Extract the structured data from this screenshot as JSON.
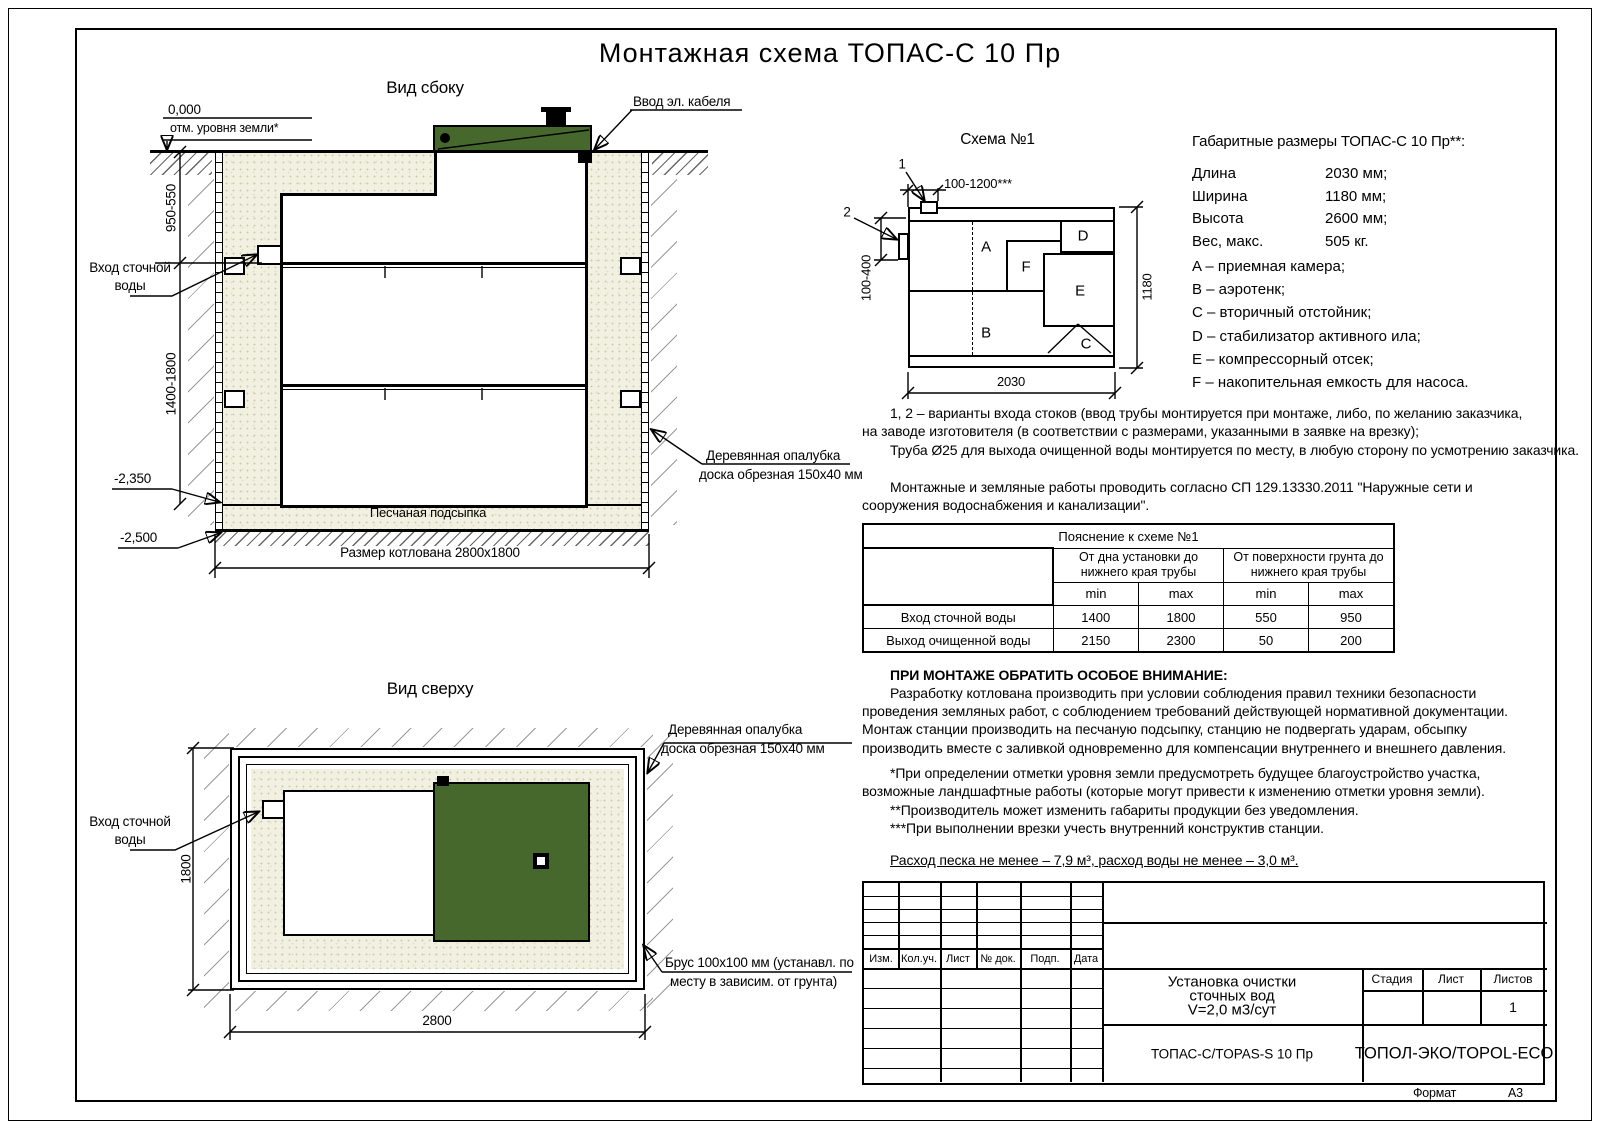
{
  "page": {
    "title": "Монтажная схема ТОПАС-С 10 Пр",
    "format_label": "Формат",
    "format_value": "А3"
  },
  "colors": {
    "lid_green": "#46682c",
    "sand": "#f2f1e1"
  },
  "labels": {
    "inlet1": "Вход сточной",
    "inlet2": "воды",
    "formwork1": "Деревянная опалубка",
    "formwork2": "доска обрезная 150х40 мм"
  },
  "side_view": {
    "title": "Вид сбоку",
    "level_zero": "0,000",
    "level_zero_note": "отм. уровня земли*",
    "cable": "Ввод эл. кабеля",
    "dim_upper": "950-550",
    "dim_lower": "1400-1800",
    "level_mid": "-2,350",
    "level_bottom": "-2,500",
    "sand": "Песчаная подсыпка",
    "pit_dim": "Размер котлована 2800х1800"
  },
  "schema": {
    "title": "Схема №1",
    "m1": "1",
    "m2": "2",
    "dim_top": "100-1200***",
    "dim_left": "100-400",
    "dim_w": "2030",
    "dim_h": "1180",
    "comp": {
      "a": "A",
      "b": "B",
      "c": "C",
      "d": "D",
      "e": "E",
      "f": "F"
    }
  },
  "dims": {
    "title": "Габаритные размеры ТОПАС-С 10 Пр**:",
    "rows": [
      {
        "l": "Длина",
        "v": "2030 мм;"
      },
      {
        "l": "Ширина",
        "v": "1180 мм;"
      },
      {
        "l": "Высота",
        "v": "2600 мм;"
      },
      {
        "l": "Вес, макс.",
        "v": "505 кг."
      }
    ]
  },
  "legend": [
    "A – приемная камера;",
    "B – аэротенк;",
    "C – вторичный отстойник;",
    "D – стабилизатор активного ила;",
    "E – компрессорный отсек;",
    "F – накопительная емкость для насоса."
  ],
  "notes": {
    "p1": "1, 2 – варианты входа  стоков (ввод трубы монтируется при монтаже, либо, по желанию заказчика, на заводе изготовителя (в соответствии с размерами, указанными в заявке на врезку);",
    "p2": "Труба Ø25 для выхода очищенной воды монтируется по месту, в любую сторону по усмотрению заказчика.",
    "p3": "Монтажные и земляные работы проводить согласно СП 129.13330.2011 \"Наружные сети и сооружения водоснабжения и канализации\"."
  },
  "table": {
    "title": "Пояснение к схеме №1",
    "g1": "От дна установки до нижнего края трубы",
    "g2": "От поверхности грунта до нижнего края трубы",
    "min": "min",
    "max": "max",
    "rows": [
      {
        "l": "Вход сточной воды",
        "v": [
          "1400",
          "1800",
          "550",
          "950"
        ]
      },
      {
        "l": "Выход очищенной воды",
        "v": [
          "2150",
          "2300",
          "50",
          "200"
        ]
      }
    ]
  },
  "attention": {
    "title": "ПРИ МОНТАЖЕ ОБРАТИТЬ ОСОБОЕ ВНИМАНИЕ:",
    "body": "Разработку котлована производить при условии соблюдения правил техники безопасности проведения земляных работ, с соблюдением требований действующей нормативной документации. Монтаж станции производить на песчаную подсыпку, станцию не подвергать ударам, обсыпку производить вместе с заливкой одновременно для компенсации внутреннего и внешнего давления."
  },
  "footnotes": [
    "*При определении отметки уровня земли предусмотреть будущее благоустройство участка, возможные ландшафтные работы (которые могут привести к изменению отметки уровня земли).",
    "**Производитель может изменить габариты продукции без уведомления.",
    "***При выполнении врезки учесть внутренний конструктив станции."
  ],
  "consumption": "Расход песка не менее – 7,9 м³, расход воды не менее – 3,0 м³.",
  "top_view": {
    "title": "Вид сверху",
    "dim_w": "2800",
    "dim_h": "1800",
    "brus1": "Брус 100х100 мм (устанавл. по",
    "brus2": "месту в зависим. от грунта)"
  },
  "title_block": {
    "cols": [
      "Изм.",
      "Кол.уч.",
      "Лист",
      "№ док.",
      "Подп.",
      "Дата"
    ],
    "doc1": "Установка очистки",
    "doc2": "сточных вод",
    "doc3": "V=2,0 м3/сут",
    "stage": "Стадия",
    "sheet": "Лист",
    "sheets": "Листов",
    "sheets_value": "1",
    "product": "ТОПАС-С/TOPAS-S 10 Пр",
    "company": "ТОПОЛ-ЭКО/TOPOL-ECO"
  }
}
